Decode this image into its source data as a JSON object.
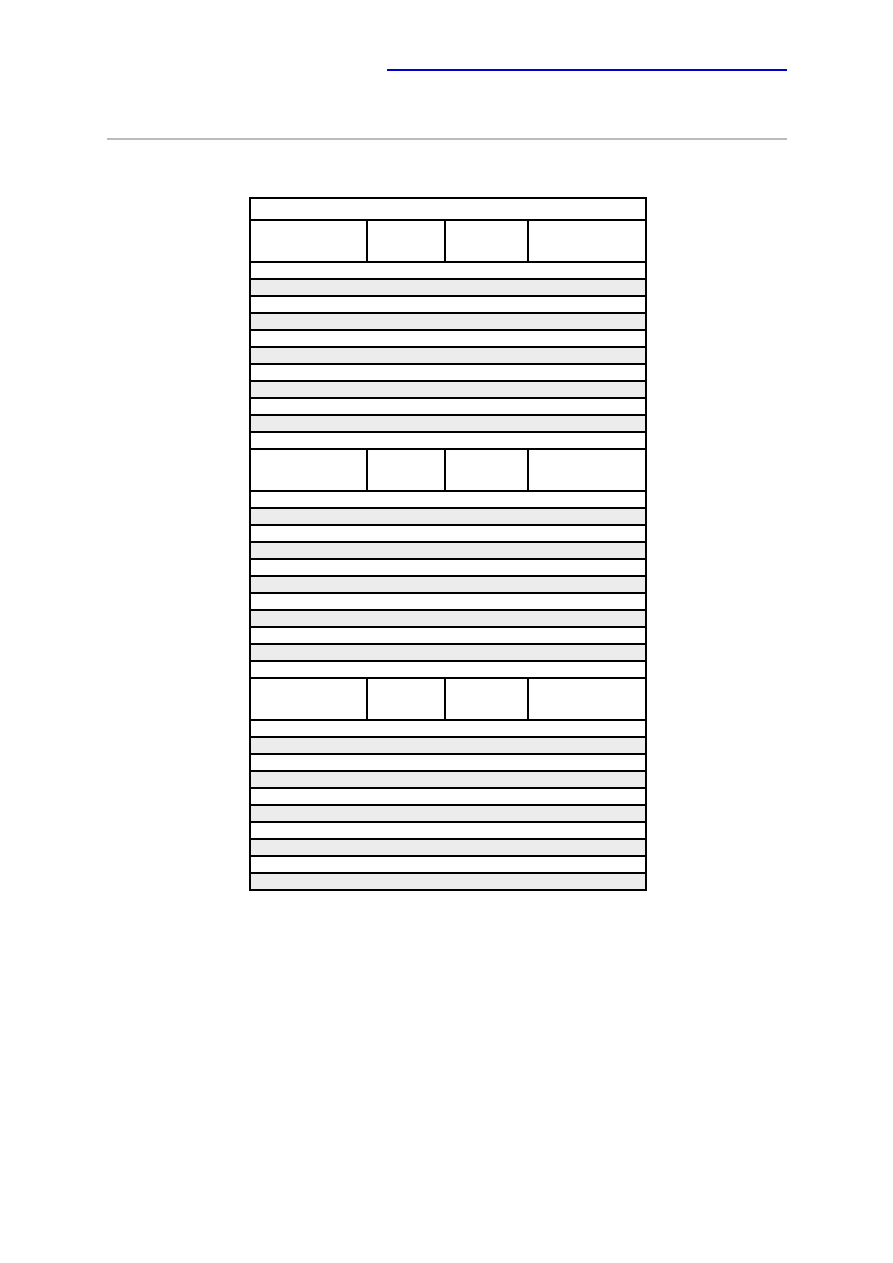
{
  "page": {
    "background_color": "#ffffff"
  },
  "top_link": {
    "underline_color": "#0000cc"
  },
  "divider": {
    "color": "#bbbbbb"
  },
  "table": {
    "border_color": "#000000",
    "row_plain_color": "#ffffff",
    "row_stripe_color": "#ececec",
    "column_widths_px": [
      117,
      78,
      83,
      118
    ],
    "rows": [
      {
        "kind": "title",
        "shaded": false
      },
      {
        "kind": "header",
        "shaded": false
      },
      {
        "kind": "data",
        "shaded": false
      },
      {
        "kind": "data",
        "shaded": true
      },
      {
        "kind": "data",
        "shaded": false
      },
      {
        "kind": "data",
        "shaded": true
      },
      {
        "kind": "data",
        "shaded": false
      },
      {
        "kind": "data",
        "shaded": true
      },
      {
        "kind": "data",
        "shaded": false
      },
      {
        "kind": "data",
        "shaded": true
      },
      {
        "kind": "data",
        "shaded": false
      },
      {
        "kind": "data",
        "shaded": true
      },
      {
        "kind": "data",
        "shaded": false
      },
      {
        "kind": "header",
        "shaded": false
      },
      {
        "kind": "data",
        "shaded": false
      },
      {
        "kind": "data",
        "shaded": true
      },
      {
        "kind": "data",
        "shaded": false
      },
      {
        "kind": "data",
        "shaded": true
      },
      {
        "kind": "data",
        "shaded": false
      },
      {
        "kind": "data",
        "shaded": true
      },
      {
        "kind": "data",
        "shaded": false
      },
      {
        "kind": "data",
        "shaded": true
      },
      {
        "kind": "data",
        "shaded": false
      },
      {
        "kind": "data",
        "shaded": true
      },
      {
        "kind": "data",
        "shaded": false
      },
      {
        "kind": "header",
        "shaded": false
      },
      {
        "kind": "data",
        "shaded": false
      },
      {
        "kind": "data",
        "shaded": true
      },
      {
        "kind": "data",
        "shaded": false
      },
      {
        "kind": "data",
        "shaded": true
      },
      {
        "kind": "data",
        "shaded": false
      },
      {
        "kind": "data",
        "shaded": true
      },
      {
        "kind": "data",
        "shaded": false
      },
      {
        "kind": "data",
        "shaded": true
      },
      {
        "kind": "data",
        "shaded": false
      },
      {
        "kind": "data",
        "shaded": true
      }
    ]
  }
}
